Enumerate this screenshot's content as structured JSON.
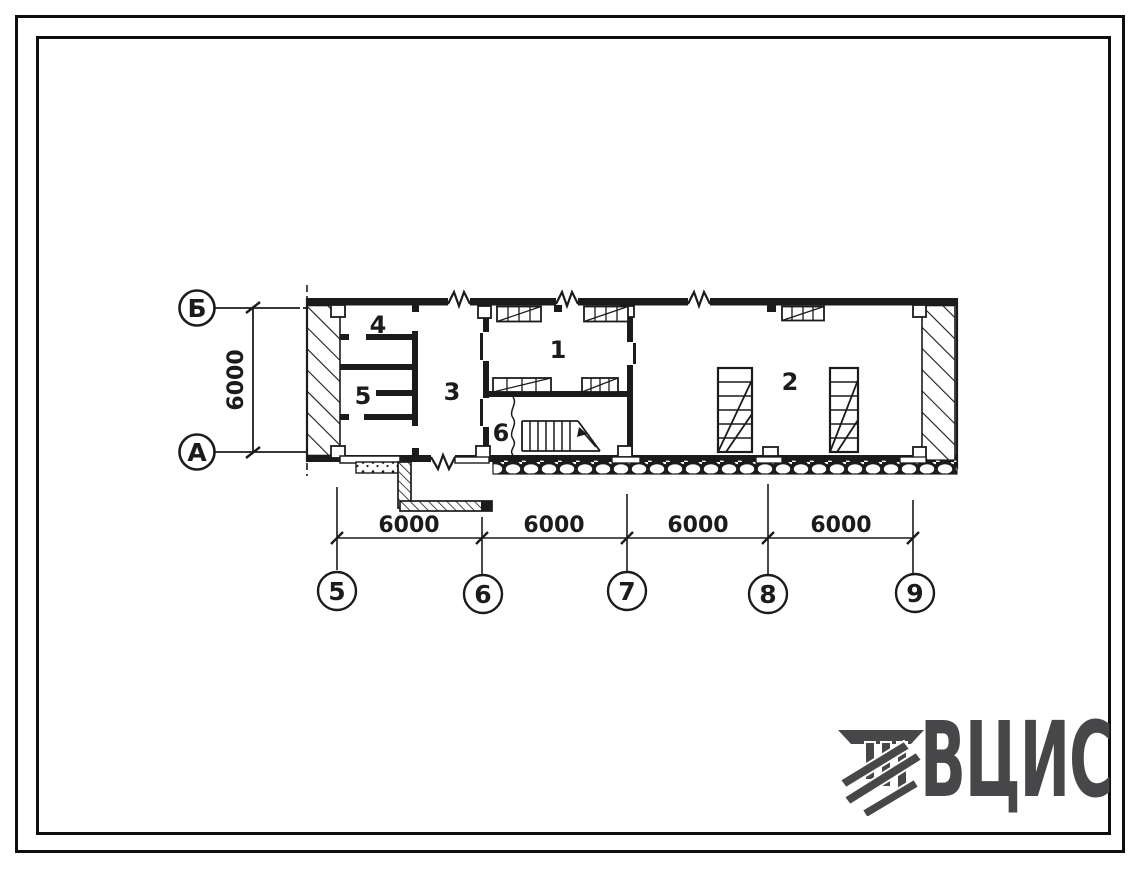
{
  "colors": {
    "line": "#1b1b1b",
    "paper": "#ffffff",
    "logo": "#47474a"
  },
  "plan": {
    "title_hint": "floor plan between axes 5-9 and A-B",
    "col_axes": [
      {
        "label": "Б"
      },
      {
        "label": "А"
      }
    ],
    "row_axes": [
      {
        "label": "5"
      },
      {
        "label": "6"
      },
      {
        "label": "7"
      },
      {
        "label": "8"
      },
      {
        "label": "9"
      }
    ],
    "vertical_dim": "6000",
    "horizontal_dims": [
      "6000",
      "6000",
      "6000",
      "6000"
    ],
    "rooms": [
      {
        "number": "1"
      },
      {
        "number": "2"
      },
      {
        "number": "3"
      },
      {
        "number": "4"
      },
      {
        "number": "5"
      },
      {
        "number": "6"
      }
    ]
  },
  "logo": {
    "text": "ВЦИС"
  }
}
